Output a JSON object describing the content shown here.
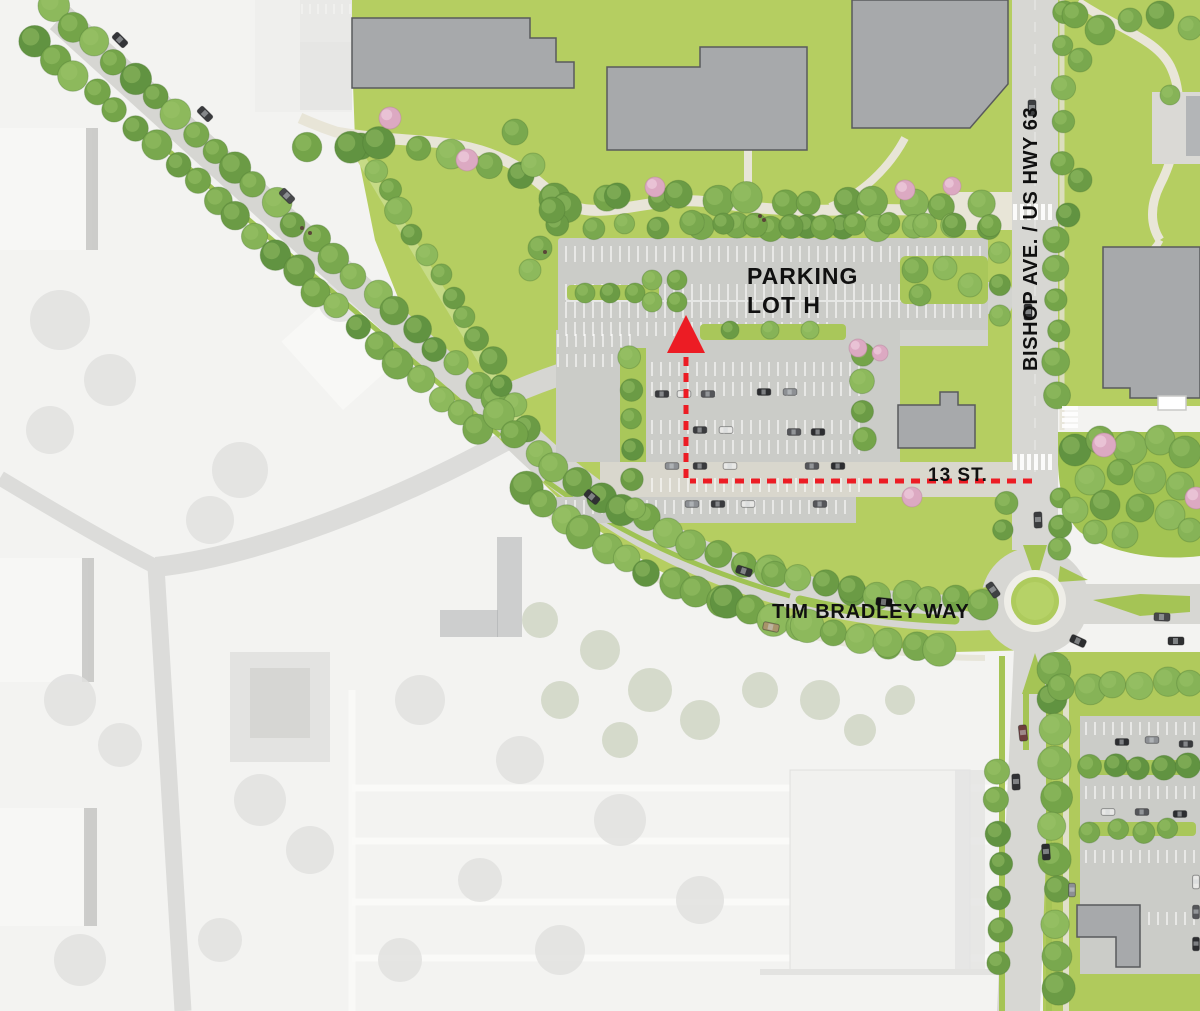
{
  "map": {
    "labels": {
      "parking_line1": "PARKING",
      "parking_line2": "LOT H",
      "highway": "BISHOP AVE. / US HWY 63",
      "street13": "13 ST.",
      "tim_bradley_way": "TIM BRADLEY WAY"
    },
    "colors": {
      "route_red": "#ec1c24",
      "lawn_green": "#b5ce61",
      "park_green": "#a3c453",
      "tree_green": "#6f9c49",
      "road_gray": "#d6d6d2",
      "lot_gray": "#cbccc8",
      "building_gray": "#a7a9ab",
      "path_tan": "#e8e5d7",
      "faded_background": "#f3f3f1",
      "label_black": "#101010"
    }
  }
}
